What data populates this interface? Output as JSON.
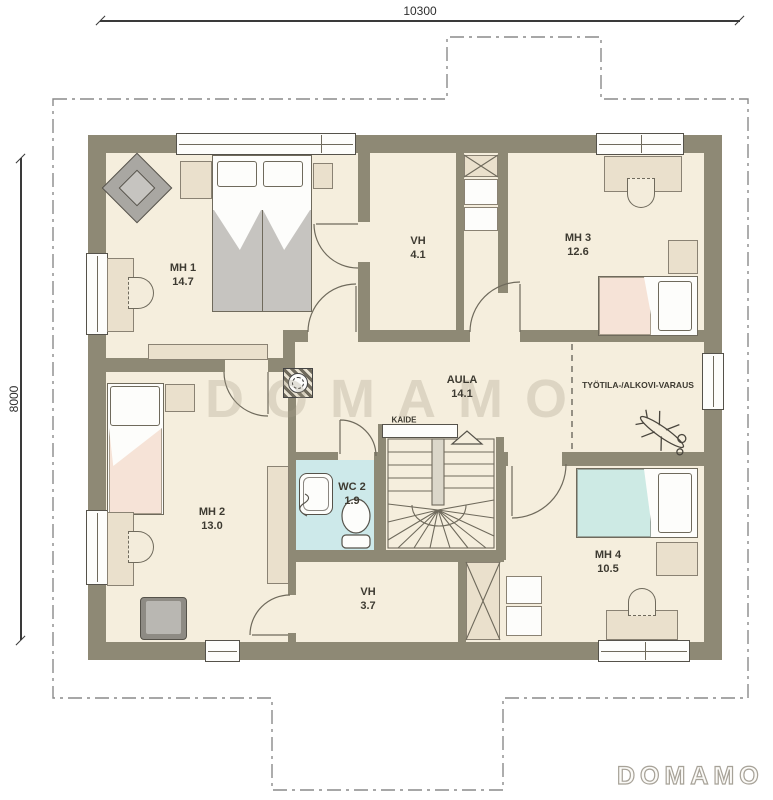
{
  "plan": {
    "title": "Upper floor plan",
    "dimensions": {
      "width_label": "10300",
      "height_label": "8000"
    },
    "rooms": [
      {
        "id": "mh1",
        "name": "MH 1",
        "area": "14.7"
      },
      {
        "id": "vh_upper",
        "name": "VH",
        "area": "4.1"
      },
      {
        "id": "mh3",
        "name": "MH 3",
        "area": "12.6"
      },
      {
        "id": "aula",
        "name": "AULA",
        "area": "14.1"
      },
      {
        "id": "tyotila",
        "name": "TYÖTILA-/ALKOVI-VARAUS",
        "area": ""
      },
      {
        "id": "mh2",
        "name": "MH 2",
        "area": "13.0"
      },
      {
        "id": "wc2",
        "name": "WC 2",
        "area": "1.9"
      },
      {
        "id": "vh_lower",
        "name": "VH",
        "area": "3.7"
      },
      {
        "id": "mh4",
        "name": "MH 4",
        "area": "10.5"
      }
    ],
    "annotations": {
      "stairs_railing": "KAIDE"
    },
    "watermark": "DOMAMO",
    "logo": "DOMAMO",
    "colors": {
      "wall": "#8e8975",
      "floor": "#f5eedd",
      "furniture": "#eae0cc",
      "wc_floor": "#cde9ea",
      "bed_pink": "#f6e3d7",
      "bed_cyan": "#cdeae4",
      "blanket_gray": "#c6c4c0",
      "armchair_gray": "#b4b2ae"
    }
  }
}
